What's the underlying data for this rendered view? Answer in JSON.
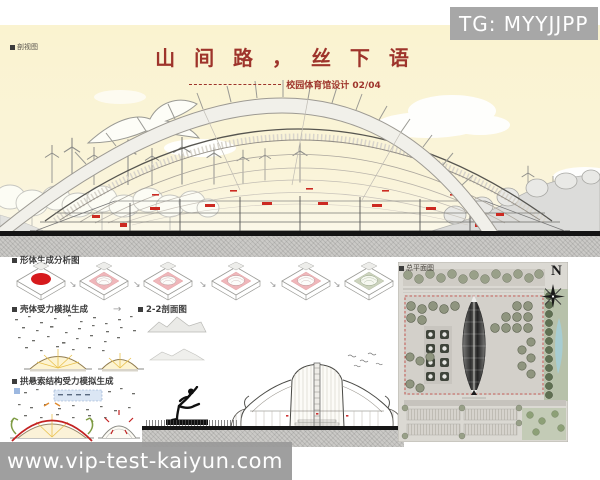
{
  "overlays": {
    "tg_watermark": "TG: MYYJJPP",
    "site_watermark": "www.vip-test-kaiyun.com"
  },
  "header": {
    "corner_label": "剖视图",
    "title": "山 间 路 ， 丝 下 语",
    "subtitle": "校园体育馆设计 02/04"
  },
  "analysis": {
    "form_generation_label": "形体生成分析图",
    "shell_simulation_label": "壳体受力模拟生成",
    "section_2_2_label": "2-2剖面图",
    "arch_cable_label": "拱悬索结构受力模拟生成"
  },
  "site_plan": {
    "label": "总平面图",
    "north_letter": "N"
  },
  "glyphs": {
    "arrow_se": "↘",
    "arrow_right": "→"
  },
  "colors": {
    "sky": "#faf3d4",
    "title_red": "#9e342b",
    "accent_red": "#d6191c",
    "diagram_pink": "#efb6ba",
    "watermark_gray": "#a7a7a7",
    "pond_blue": "#a7cdd2",
    "glow_yellow": "#e9c14d"
  }
}
